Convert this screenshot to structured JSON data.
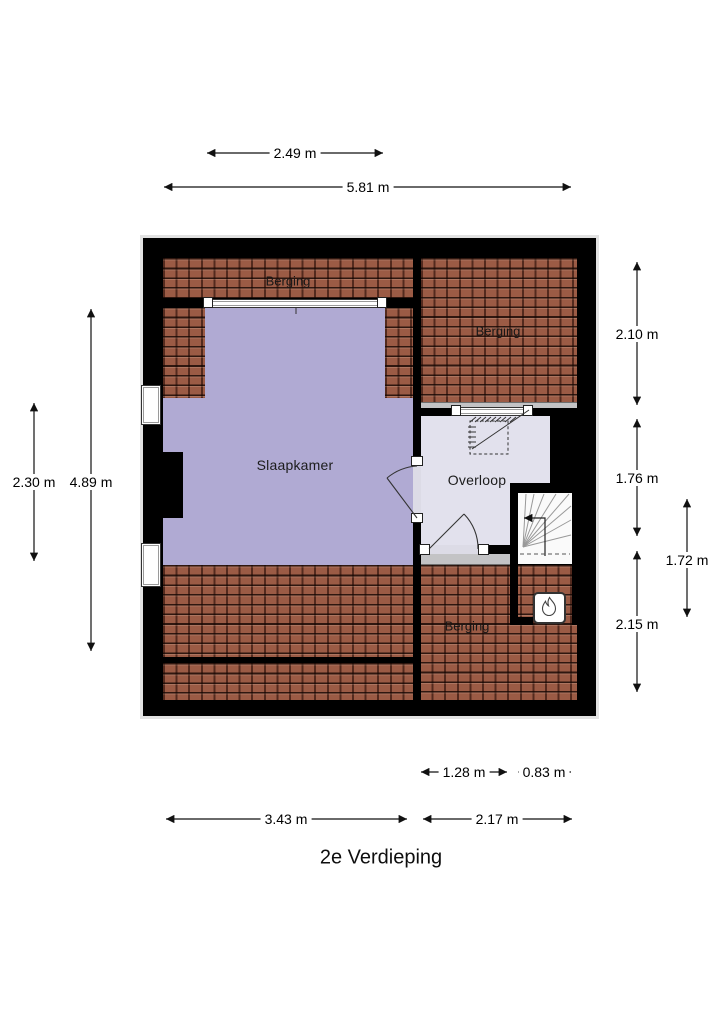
{
  "title": "2e Verdieping",
  "rooms": {
    "bedroom": "Slaapkamer",
    "landing": "Overloop",
    "storage_top_left": "Berging",
    "storage_top_right": "Berging",
    "storage_bottom": "Berging"
  },
  "dimensions": {
    "top_window_width": "2.49 m",
    "total_width": "5.81 m",
    "left_inner_height": "2.30 m",
    "left_total_height": "4.89 m",
    "right_top_height": "2.10 m",
    "right_landing_height": "1.76 m",
    "stairs_height": "1.72 m",
    "right_bottom_height": "2.15 m",
    "landing_width": "1.28 m",
    "stairs_width": "0.83 m",
    "bottom_left_width": "3.43 m",
    "bottom_right_width": "2.17 m"
  },
  "icons": {
    "boiler": "flame-icon",
    "stair_direction": "arrow-left-icon"
  },
  "colors": {
    "wall": "#000000",
    "roof_tiles": "#9b5b45",
    "bedroom_floor": "#b0aad3",
    "landing_floor": "#e2e1ed",
    "knee_wall": "#c3c3c5"
  }
}
